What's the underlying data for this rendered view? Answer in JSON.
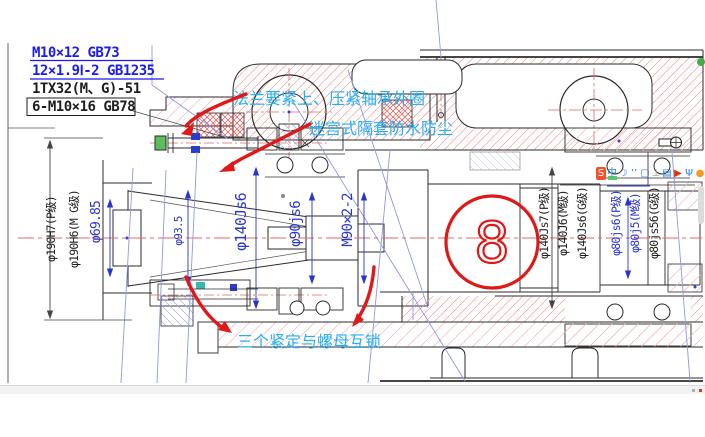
{
  "drawing": {
    "notes": [
      "M10×12 GB73",
      "12×1.9Ⅰ-2 GB1235",
      "1TX32(M、G)-51",
      "6-M10×16 GB78"
    ],
    "annotations": {
      "flange": "法兰要紧上、压紧轴承外圈",
      "labyrinth": "迷宫式隔套防水防尘",
      "locking": "三个紧定与螺母互锁",
      "circled_number": "8"
    },
    "dimensions": {
      "bore_left": [
        "φ190H7(P级)",
        "φ190H6(M G级)"
      ],
      "spindle": [
        "φ69.85",
        "φ93.5",
        "φ140Js6",
        "φ90js6",
        "M90×2-2"
      ],
      "right_140": [
        "φ140Js7(P级)",
        "φ140J6(M级)",
        "φ140Js6(G级)"
      ],
      "right_80": [
        "φ80js6(P级)",
        "φ80j5(M级)",
        "φ80js56(G级)"
      ]
    },
    "colors": {
      "annotation_cyan": "#25b0f5",
      "markup_red": "#e01818",
      "dim_blue": "#2a35cc",
      "note_blue": "#1b1bf0",
      "hatch_red": "#f29d9d",
      "construction_blue": "#8f97e8"
    }
  },
  "ime_bar": {
    "icons": [
      {
        "name": "sogou-logo-icon",
        "glyph": "S",
        "fg": "#ffffff",
        "bg": "#f4502c"
      },
      {
        "name": "chinese-mode-icon",
        "glyph": "中",
        "fg": "#2f7fe8",
        "bg": "transparent"
      },
      {
        "name": "fullwidth-icon",
        "glyph": "☽",
        "fg": "#2f7fe8",
        "bg": "transparent"
      },
      {
        "name": "punctuation-icon",
        "glyph": "’’",
        "fg": "#2f7fe8",
        "bg": "transparent"
      },
      {
        "name": "softkeyboard-icon",
        "glyph": "▢",
        "fg": "#2f7fe8",
        "bg": "transparent"
      },
      {
        "name": "handwriting-icon",
        "glyph": "⊥",
        "fg": "#9aa0a8",
        "bg": "transparent"
      },
      {
        "name": "clipboard-icon",
        "glyph": "▤",
        "fg": "#2f7fe8",
        "bg": "transparent"
      },
      {
        "name": "skin-icon",
        "glyph": "▶",
        "fg": "#e03010",
        "bg": "transparent"
      },
      {
        "name": "toolbox-icon",
        "glyph": "Ψ",
        "fg": "#2f7fe8",
        "bg": "transparent"
      },
      {
        "name": "settings-icon",
        "glyph": "●",
        "fg": "#f59a23",
        "bg": "transparent"
      }
    ]
  }
}
